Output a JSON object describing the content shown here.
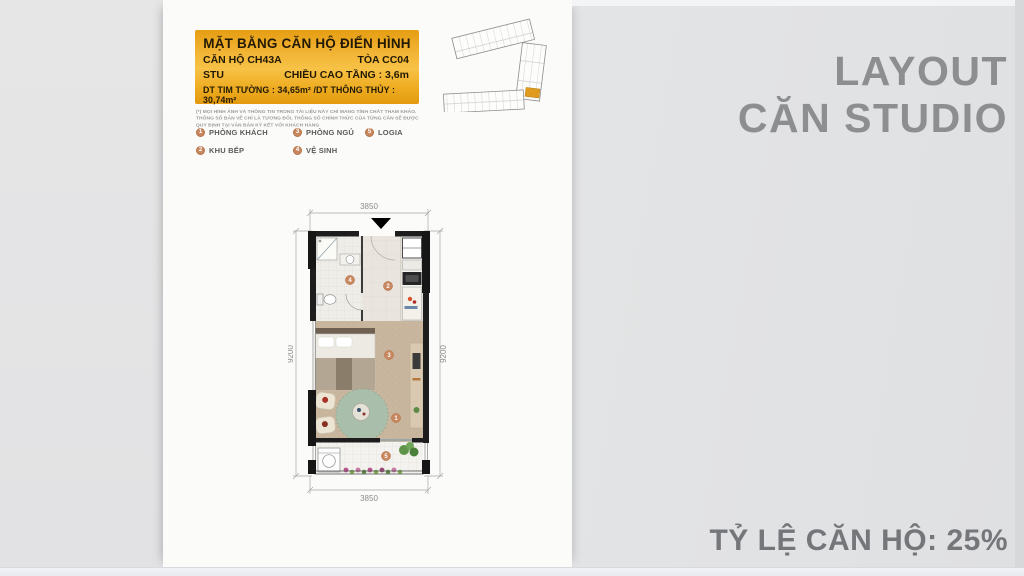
{
  "slide": {
    "side_title_line1": "LAYOUT",
    "side_title_line2": "CĂN STUDIO",
    "ratio_label": "TỶ LỆ CĂN HỘ: 25%"
  },
  "header_box": {
    "title": "MẶT BẰNG CĂN HỘ ĐIỂN HÌNH",
    "unit_code": "CĂN HỘ CH43A",
    "tower": "TÒA CC04",
    "unit_type": "STU",
    "floor_height": "CHIỀU CAO TẦNG : 3,6m",
    "areas": "DT TIM TƯỜNG : 34,65m² /DT THÔNG THỦY : 30,74m²"
  },
  "disclaimer": "(*) MỌI HÌNH ẢNH VÀ THÔNG TIN TRONG TÀI LIỆU NÀY CHỈ MANG TÍNH CHẤT THAM KHẢO. THÔNG SỐ BẢN VẼ CHỈ LÀ TƯƠNG ĐỐI, THÔNG SỐ CHÍNH THỨC CỦA TỪNG CĂN SẼ ĐƯỢC QUY ĐỊNH TẠI VĂN BẢN KÝ KẾT VỚI KHÁCH HÀNG",
  "legend": {
    "items": [
      {
        "num": "1",
        "label": "PHÒNG KHÁCH"
      },
      {
        "num": "3",
        "label": "PHÒNG NGỦ"
      },
      {
        "num": "5",
        "label": "LOGIA"
      },
      {
        "num": "2",
        "label": "KHU BẾP"
      },
      {
        "num": "4",
        "label": "VỆ SINH"
      }
    ]
  },
  "floor_plan": {
    "dim_width_top": "3850",
    "dim_width_bottom": "3850",
    "dim_height_left": "9200",
    "dim_height_right": "9200",
    "markers": {
      "living": "1",
      "kitchen": "2",
      "bedroom": "3",
      "bathroom": "4",
      "logia": "5"
    }
  },
  "colors": {
    "gold_accent": "#f0b232",
    "marker": "#c8875f",
    "side_title_gray": "#8d8e90",
    "ratio_gray": "#75767a",
    "wall_black": "#1d1d1d",
    "rug_green": "#a9bfab",
    "wood_floor": "#c9b69e",
    "highlight_unit_orange": "#e09a1e"
  }
}
